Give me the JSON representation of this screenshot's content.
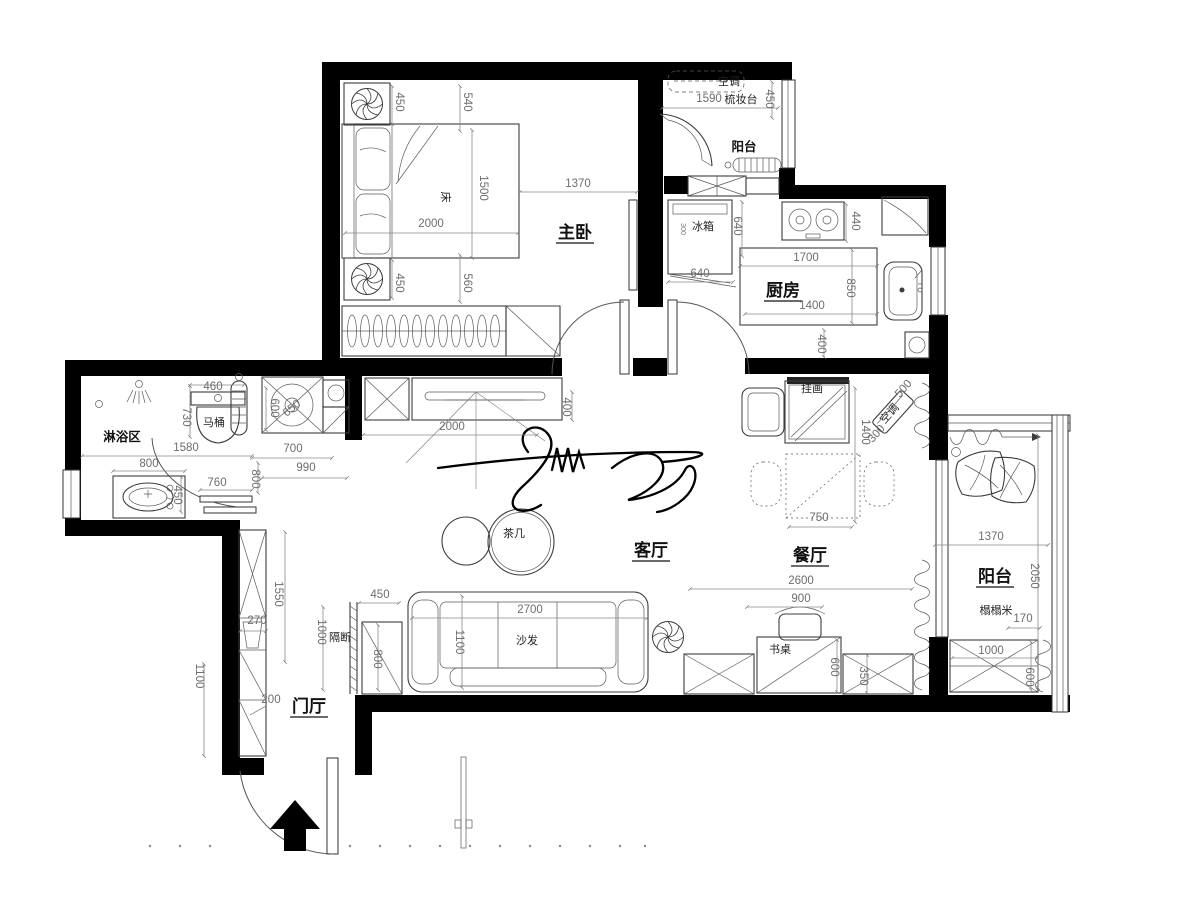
{
  "plan": {
    "type": "apartment-floor-plan",
    "wall_color": "#000000",
    "line_color": "#3c3c3c",
    "dim_color": "#6d6d6d",
    "labels": [
      {
        "text": "主卧",
        "x": 575,
        "y": 238,
        "cls": "room",
        "u": 1,
        "name": "room-label-master-bedroom"
      },
      {
        "text": "厨房",
        "x": 783,
        "y": 296,
        "cls": "room",
        "u": 1,
        "name": "room-label-kitchen"
      },
      {
        "text": "客厅",
        "x": 651,
        "y": 556,
        "cls": "room",
        "u": 1,
        "name": "room-label-living-room"
      },
      {
        "text": "餐厅",
        "x": 810,
        "y": 561,
        "cls": "room",
        "u": 1,
        "name": "room-label-dining-room"
      },
      {
        "text": "阳台",
        "x": 995,
        "y": 582,
        "cls": "room",
        "u": 1,
        "name": "room-label-balcony-east"
      },
      {
        "text": "门厅",
        "x": 309,
        "y": 712,
        "cls": "room",
        "u": 1,
        "name": "room-label-entry-hall"
      },
      {
        "text": "阳台",
        "x": 744,
        "y": 151,
        "cls": "room2",
        "name": "room-label-balcony-north"
      },
      {
        "text": "淋浴区",
        "x": 122,
        "y": 441,
        "cls": "room2",
        "name": "room-label-shower-area"
      },
      {
        "text": "床",
        "x": 442,
        "y": 197,
        "r": 90,
        "cls": "furn",
        "name": "furniture-label-bed"
      },
      {
        "text": "茶几",
        "x": 514,
        "y": 537,
        "cls": "furn",
        "name": "furniture-label-tea-table"
      },
      {
        "text": "沙发",
        "x": 527,
        "y": 644,
        "cls": "furn",
        "name": "furniture-label-sofa"
      },
      {
        "text": "书桌",
        "x": 780,
        "y": 653,
        "cls": "furn",
        "name": "furniture-label-desk"
      },
      {
        "text": "挂画",
        "x": 812,
        "y": 392,
        "cls": "furn",
        "name": "furniture-label-hanging-picture"
      },
      {
        "text": "冰箱",
        "x": 703,
        "y": 230,
        "cls": "furn",
        "name": "furniture-label-fridge"
      },
      {
        "text": "300",
        "x": 681,
        "y": 229,
        "r": 90,
        "cls": "dim-sm",
        "name": "fridge-size-note"
      },
      {
        "text": "马桶",
        "x": 214,
        "y": 426,
        "cls": "furn",
        "name": "furniture-label-toilet"
      },
      {
        "text": "梳妆台",
        "x": 741,
        "y": 103,
        "cls": "furn",
        "name": "furniture-label-dresser"
      },
      {
        "text": "榻榻米",
        "x": 996,
        "y": 614,
        "cls": "furn",
        "name": "furniture-label-tatami"
      },
      {
        "text": "隔断",
        "x": 340,
        "y": 641,
        "cls": "furn",
        "name": "furniture-label-partition"
      },
      {
        "text": "空调",
        "x": 729,
        "y": 85,
        "cls": "furn",
        "name": "furniture-label-ac-north"
      },
      {
        "text": "空调",
        "x": 892,
        "y": 416,
        "r": -48,
        "cls": "furn",
        "name": "furniture-label-ac-dining"
      },
      {
        "text": "450",
        "x": 396,
        "y": 102,
        "r": 90,
        "cls": "dim"
      },
      {
        "text": "540",
        "x": 464,
        "y": 102,
        "r": 90,
        "cls": "dim"
      },
      {
        "text": "1500",
        "x": 480,
        "y": 188,
        "r": 90,
        "cls": "dim"
      },
      {
        "text": "2000",
        "x": 431,
        "y": 227,
        "cls": "dim"
      },
      {
        "text": "1370",
        "x": 578,
        "y": 187,
        "cls": "dim"
      },
      {
        "text": "450",
        "x": 396,
        "y": 283,
        "r": 90,
        "cls": "dim"
      },
      {
        "text": "560",
        "x": 464,
        "y": 283,
        "r": 90,
        "cls": "dim"
      },
      {
        "text": "1590",
        "x": 709,
        "y": 102,
        "cls": "dim"
      },
      {
        "text": "450",
        "x": 766,
        "y": 99,
        "r": 90,
        "cls": "dim"
      },
      {
        "text": "640",
        "x": 700,
        "y": 277,
        "cls": "dim"
      },
      {
        "text": "640",
        "x": 734,
        "y": 226,
        "r": 90,
        "cls": "dim"
      },
      {
        "text": "440",
        "x": 852,
        "y": 221,
        "r": 90,
        "cls": "dim"
      },
      {
        "text": "1700",
        "x": 806,
        "y": 261,
        "cls": "dim"
      },
      {
        "text": "850",
        "x": 847,
        "y": 288,
        "r": 90,
        "cls": "dim"
      },
      {
        "text": "1400",
        "x": 812,
        "y": 309,
        "cls": "dim"
      },
      {
        "text": "400",
        "x": 818,
        "y": 344,
        "r": 90,
        "cls": "dim"
      },
      {
        "text": "460",
        "x": 213,
        "y": 390,
        "cls": "dim"
      },
      {
        "text": "730",
        "x": 183,
        "y": 417,
        "r": 90,
        "cls": "dim"
      },
      {
        "text": "1580",
        "x": 186,
        "y": 451,
        "cls": "dim"
      },
      {
        "text": "800",
        "x": 149,
        "y": 467,
        "cls": "dim"
      },
      {
        "text": "450",
        "x": 174,
        "y": 495,
        "r": 90,
        "cls": "dim"
      },
      {
        "text": "600",
        "x": 271,
        "y": 408,
        "r": 90,
        "cls": "dim"
      },
      {
        "text": "650",
        "x": 294,
        "y": 411,
        "r": -40,
        "cls": "dim"
      },
      {
        "text": "760",
        "x": 217,
        "y": 486,
        "cls": "dim"
      },
      {
        "text": "800",
        "x": 252,
        "y": 479,
        "r": 90,
        "cls": "dim"
      },
      {
        "text": "700",
        "x": 293,
        "y": 452,
        "cls": "dim"
      },
      {
        "text": "990",
        "x": 306,
        "y": 471,
        "cls": "dim"
      },
      {
        "text": "400",
        "x": 563,
        "y": 407,
        "r": 90,
        "cls": "dim"
      },
      {
        "text": "2000",
        "x": 452,
        "y": 430,
        "cls": "dim"
      },
      {
        "text": "450",
        "x": 380,
        "y": 598,
        "cls": "dim"
      },
      {
        "text": "1000",
        "x": 318,
        "y": 632,
        "r": 90,
        "cls": "dim"
      },
      {
        "text": "800",
        "x": 374,
        "y": 659,
        "r": 90,
        "cls": "dim"
      },
      {
        "text": "2700",
        "x": 530,
        "y": 613,
        "cls": "dim"
      },
      {
        "text": "1100",
        "x": 456,
        "y": 642,
        "r": 90,
        "cls": "dim"
      },
      {
        "text": "1550",
        "x": 275,
        "y": 594,
        "r": 90,
        "cls": "dim"
      },
      {
        "text": "270",
        "x": 257,
        "y": 624,
        "cls": "dim"
      },
      {
        "text": "200",
        "x": 271,
        "y": 703,
        "cls": "dim"
      },
      {
        "text": "1100",
        "x": 196,
        "y": 676,
        "r": 90,
        "cls": "dim"
      },
      {
        "text": "2600",
        "x": 801,
        "y": 584,
        "cls": "dim"
      },
      {
        "text": "900",
        "x": 801,
        "y": 602,
        "cls": "dim"
      },
      {
        "text": "600",
        "x": 831,
        "y": 667,
        "r": 90,
        "cls": "dim"
      },
      {
        "text": "350",
        "x": 860,
        "y": 676,
        "r": 90,
        "cls": "dim"
      },
      {
        "text": "750",
        "x": 819,
        "y": 521,
        "cls": "dim"
      },
      {
        "text": "1400",
        "x": 862,
        "y": 432,
        "r": 90,
        "cls": "dim"
      },
      {
        "text": "500",
        "x": 906,
        "y": 391,
        "r": -48,
        "cls": "dim"
      },
      {
        "text": "300",
        "x": 879,
        "y": 436,
        "r": -48,
        "cls": "dim"
      },
      {
        "text": "1370",
        "x": 991,
        "y": 540,
        "cls": "dim"
      },
      {
        "text": "2050",
        "x": 1031,
        "y": 576,
        "r": 90,
        "cls": "dim"
      },
      {
        "text": "170",
        "x": 1023,
        "y": 622,
        "cls": "dim"
      },
      {
        "text": "1000",
        "x": 991,
        "y": 654,
        "cls": "dim"
      },
      {
        "text": "600",
        "x": 1026,
        "y": 677,
        "r": 90,
        "cls": "dim"
      }
    ]
  }
}
